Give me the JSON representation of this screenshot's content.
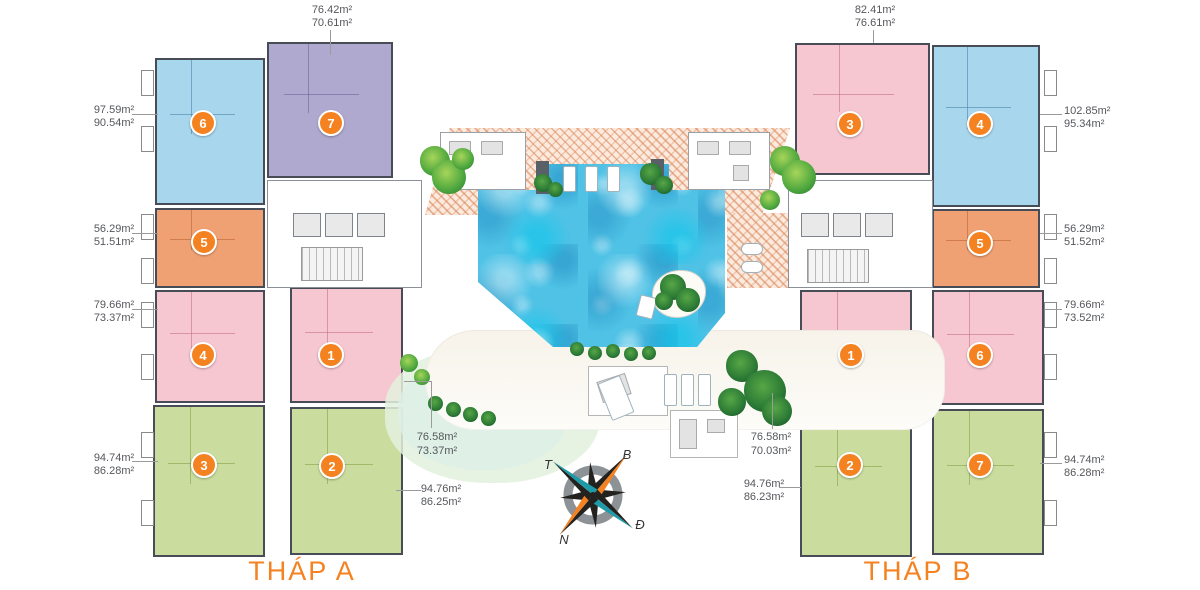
{
  "plan": {
    "type": "residential floor plan with central pool courtyard",
    "compass": {
      "north": "B",
      "east": "Đ",
      "south": "N",
      "west": "T"
    },
    "colors": {
      "badge": "#f58220",
      "tower_label": "#f58220",
      "area_label_text": "#55575c",
      "pool_water": "#4fc2e6",
      "unit_blue": "#a8d6ec",
      "unit_purple": "#b0a9cf",
      "unit_orange": "#f0a173",
      "unit_pink": "#f6c6d1",
      "unit_green": "#cadd9e",
      "deck_hatch": "#d87e4f"
    }
  },
  "towers": [
    {
      "label": "THÁP A",
      "units": [
        {
          "number": "6",
          "color": "blue",
          "gross_area": "97.59m²",
          "net_area": "90.54m²"
        },
        {
          "number": "7",
          "color": "purple",
          "gross_area": "76.42m²",
          "net_area": "70.61m²"
        },
        {
          "number": "5",
          "color": "orange",
          "gross_area": "56.29m²",
          "net_area": "51.51m²"
        },
        {
          "number": "4",
          "color": "pink",
          "gross_area": "79.66m²",
          "net_area": "73.37m²"
        },
        {
          "number": "1",
          "color": "pink",
          "gross_area": "76.58m²",
          "net_area": "73.37m²"
        },
        {
          "number": "3",
          "color": "green",
          "gross_area": "94.74m²",
          "net_area": "86.28m²"
        },
        {
          "number": "2",
          "color": "green",
          "gross_area": "94.76m²",
          "net_area": "86.25m²"
        }
      ]
    },
    {
      "label": "THÁP B",
      "units": [
        {
          "number": "3",
          "color": "pink",
          "gross_area": "82.41m²",
          "net_area": "76.61m²"
        },
        {
          "number": "4",
          "color": "blue",
          "gross_area": "102.85m²",
          "net_area": "95.34m²"
        },
        {
          "number": "5",
          "color": "orange",
          "gross_area": "56.29m²",
          "net_area": "51.52m²"
        },
        {
          "number": "1",
          "color": "pink",
          "gross_area": "76.58m²",
          "net_area": "70.03m²"
        },
        {
          "number": "6",
          "color": "pink",
          "gross_area": "79.66m²",
          "net_area": "73.52m²"
        },
        {
          "number": "2",
          "color": "green",
          "gross_area": "94.76m²",
          "net_area": "86.23m²"
        },
        {
          "number": "7",
          "color": "green",
          "gross_area": "94.74m²",
          "net_area": "86.28m²"
        }
      ]
    }
  ]
}
